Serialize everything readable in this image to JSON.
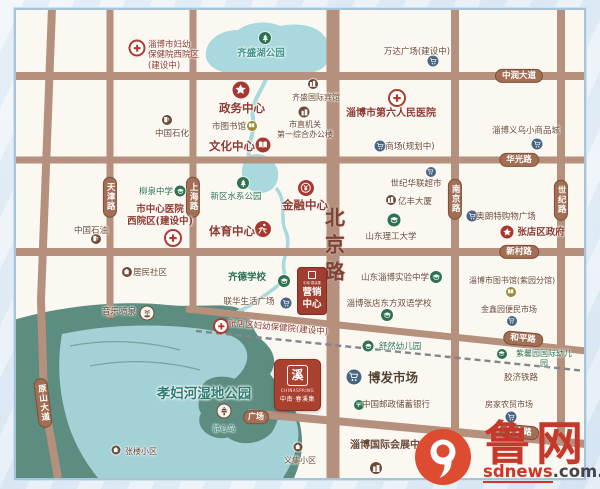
{
  "colors": {
    "maroon": "#8e3a30",
    "brown": "#6d4a36",
    "green": "#2e7350",
    "teal": "#3f948c",
    "blue": "#4a6580",
    "red": "#a8372e",
    "olive": "#9c8b33",
    "darkbrown": "#54412e",
    "wetland": "#2f7d72"
  },
  "big_road": {
    "t": "北京路"
  },
  "road_labels": [
    {
      "id": "zhongrun-avenue",
      "t": "中润大道",
      "x": 519,
      "y": 76
    },
    {
      "id": "huaguang-road",
      "t": "华光路",
      "x": 519,
      "y": 160
    },
    {
      "id": "xincun-road",
      "t": "新村路",
      "x": 519,
      "y": 252
    },
    {
      "id": "heping-road",
      "t": "和平路",
      "x": 523,
      "y": 339,
      "r": 5
    },
    {
      "id": "wangshe-road",
      "t": "王舍路",
      "x": 519,
      "y": 432,
      "r": 5
    },
    {
      "id": "tianjin-road",
      "t": "天津路",
      "x": 110,
      "y": 197,
      "v": 1
    },
    {
      "id": "shanghai-road",
      "t": "上海路",
      "x": 193,
      "y": 197,
      "v": 1
    },
    {
      "id": "nanjing-road",
      "t": "南京路",
      "x": 455,
      "y": 199,
      "v": 1
    },
    {
      "id": "shiji-road",
      "t": "世纪路",
      "x": 561,
      "y": 200,
      "v": 1
    },
    {
      "id": "yuanshan-avenue",
      "t": "原山大道",
      "x": 43,
      "y": 403,
      "v": 1,
      "r": -7
    },
    {
      "id": "plaza",
      "t": "广场",
      "x": 256,
      "y": 417,
      "small": 1
    }
  ],
  "pois": [
    {
      "id": "zibo-maternity-west-hospital",
      "ic": "cross",
      "c": "ring",
      "x": 137,
      "y": 48,
      "s": 13
    },
    {
      "id": "sinopec",
      "ic": "pump",
      "c": "brown",
      "x": 167,
      "y": 120,
      "s": 10
    },
    {
      "id": "government-center",
      "ic": "star",
      "c": "red",
      "x": 241,
      "y": 90,
      "s": 17
    },
    {
      "id": "city-library",
      "ic": "book",
      "c": "olive",
      "x": 252,
      "y": 126,
      "s": 10
    },
    {
      "id": "culture-center",
      "ic": "book",
      "c": "red",
      "x": 263,
      "y": 145,
      "s": 15
    },
    {
      "id": "qisheng-lake-park",
      "ic": "tree",
      "c": "green",
      "x": 265,
      "y": 38,
      "s": 12
    },
    {
      "id": "qisheng-intl-hotel",
      "ic": "building",
      "c": "brown",
      "x": 313,
      "y": 84,
      "s": 10
    },
    {
      "id": "municipal-office",
      "ic": "building",
      "c": "brown",
      "x": 304,
      "y": 112,
      "s": 11
    },
    {
      "id": "wanda-plaza",
      "ic": "cart",
      "c": "blue",
      "x": 433,
      "y": 61,
      "s": 11
    },
    {
      "id": "sixth-peoples-hospital",
      "ic": "cross",
      "c": "ring",
      "x": 397,
      "y": 98,
      "s": 14
    },
    {
      "id": "yiwu-commodity-city",
      "ic": "cart",
      "c": "blue",
      "x": 537,
      "y": 144,
      "s": 11
    },
    {
      "id": "mall-planned",
      "ic": "cart",
      "c": "blue",
      "x": 380,
      "y": 146,
      "s": 11
    },
    {
      "id": "century-hualian-supermarket",
      "ic": "cart",
      "c": "blue",
      "x": 431,
      "y": 172,
      "s": 10
    },
    {
      "id": "yifeng-tower",
      "ic": "building",
      "c": "brown",
      "x": 391,
      "y": 200,
      "s": 10
    },
    {
      "id": "aolangte-mall",
      "ic": "cart",
      "c": "blue",
      "x": 472,
      "y": 216,
      "s": 11
    },
    {
      "id": "zhangdian-government",
      "ic": "star",
      "c": "red",
      "x": 507,
      "y": 232,
      "s": 13
    },
    {
      "id": "shandong-univ-tech",
      "ic": "cap",
      "c": "green",
      "x": 394,
      "y": 220,
      "s": 13
    },
    {
      "id": "liuquan-middle-school",
      "ic": "cap",
      "c": "green",
      "x": 180,
      "y": 191,
      "s": 11
    },
    {
      "id": "central-hospital-west",
      "ic": "cross",
      "c": "ring",
      "x": 173,
      "y": 238,
      "s": 14
    },
    {
      "id": "petrochina",
      "ic": "pump",
      "c": "brown",
      "x": 96,
      "y": 239,
      "s": 10
    },
    {
      "id": "residential-community",
      "ic": "house",
      "c": "brown",
      "x": 127,
      "y": 272,
      "s": 10
    },
    {
      "id": "water-system-park",
      "ic": "tree",
      "c": "green",
      "x": 243,
      "y": 183,
      "s": 12
    },
    {
      "id": "sports-center",
      "ic": "runner",
      "c": "red",
      "x": 263,
      "y": 229,
      "s": 16
    },
    {
      "id": "finance-center",
      "ic": "money",
      "c": "red",
      "x": 306,
      "y": 188,
      "s": 16
    },
    {
      "id": "qide-school",
      "ic": "cap",
      "c": "green",
      "x": 284,
      "y": 281,
      "s": 12
    },
    {
      "id": "lianhua-life-plaza",
      "ic": "cart",
      "c": "blue",
      "x": 286,
      "y": 303,
      "s": 11
    },
    {
      "id": "zhangdian-maternity-hospital",
      "ic": "cross",
      "c": "ring",
      "x": 221,
      "y": 326,
      "s": 12
    },
    {
      "id": "experimental-middle-school",
      "ic": "cap",
      "c": "green",
      "x": 436,
      "y": 277,
      "s": 12
    },
    {
      "id": "library-ziyuan-branch",
      "ic": "book",
      "c": "olive",
      "x": 511,
      "y": 292,
      "s": 10
    },
    {
      "id": "oriental-bilingual-school",
      "ic": "cap",
      "c": "green",
      "x": 387,
      "y": 315,
      "s": 12
    },
    {
      "id": "jinxinyuan-market",
      "ic": "cart",
      "c": "blue",
      "x": 512,
      "y": 321,
      "s": 10
    },
    {
      "id": "shuran-kindergarten",
      "ic": "cap",
      "c": "green",
      "x": 368,
      "y": 346,
      "s": 11
    },
    {
      "id": "zixinyuan-kindergarten",
      "ic": "cap",
      "c": "green",
      "x": 502,
      "y": 354,
      "s": 10
    },
    {
      "id": "bofa-market",
      "ic": "cart",
      "c": "blue",
      "x": 354,
      "y": 377,
      "s": 15
    },
    {
      "id": "postal-savings-bank",
      "ic": "post",
      "c": "green",
      "x": 359,
      "y": 405,
      "s": 10
    },
    {
      "id": "fangjia-market",
      "ic": "cart",
      "c": "blue",
      "x": 511,
      "y": 417,
      "s": 11
    },
    {
      "id": "intl-convention-center",
      "ic": "building",
      "c": "brown",
      "x": 376,
      "y": 468,
      "s": 12
    },
    {
      "id": "yiji-community",
      "ic": "house",
      "c": "brown",
      "x": 298,
      "y": 447,
      "s": 9
    },
    {
      "id": "zhanglou-community",
      "ic": "house",
      "c": "brown",
      "x": 116,
      "y": 450,
      "s": 9
    },
    {
      "id": "music-fountain",
      "ic": "fountain",
      "c": "wb",
      "x": 147,
      "y": 313,
      "s": 13
    },
    {
      "id": "jingxin-island-pagoda",
      "ic": "pagoda",
      "c": "wb",
      "x": 224,
      "y": 411,
      "s": 13
    }
  ],
  "labels": [
    {
      "id": "zibo-maternity-west-hospital",
      "t": "淄博市妇幼\n保健院西院区\n(建设中)",
      "x": 148,
      "y": 40,
      "c": "maroon",
      "s": 8.5,
      "a": "l"
    },
    {
      "id": "sinopec",
      "t": "中国石化",
      "x": 172,
      "y": 129,
      "c": "brown",
      "s": 8.5
    },
    {
      "id": "government-center",
      "t": "政务中心",
      "x": 242,
      "y": 101,
      "c": "maroon",
      "s": 11.5,
      "b": 1
    },
    {
      "id": "city-library",
      "t": "市图书馆",
      "x": 229,
      "y": 122,
      "c": "brown",
      "s": 8.5
    },
    {
      "id": "culture-center",
      "t": "文化中心",
      "x": 232,
      "y": 139,
      "c": "maroon",
      "s": 11.5,
      "b": 1
    },
    {
      "id": "qisheng-lake-park",
      "t": "齐盛湖公园",
      "x": 261,
      "y": 48,
      "c": "teal",
      "s": 9.5,
      "b": 1
    },
    {
      "id": "qisheng-intl-hotel",
      "t": "齐盛国际宾馆",
      "x": 316,
      "y": 93,
      "c": "brown",
      "s": 8
    },
    {
      "id": "municipal-office",
      "t": "市直机关\n第一综合办公楼",
      "x": 305,
      "y": 120,
      "c": "brown",
      "s": 8
    },
    {
      "id": "wanda-plaza",
      "t": "万达广场(建设中)",
      "x": 417,
      "y": 47,
      "c": "brown",
      "s": 8.5
    },
    {
      "id": "sixth-peoples-hospital",
      "t": "淄博市第六人民医院",
      "x": 391,
      "y": 108,
      "c": "maroon",
      "s": 10,
      "b": 1
    },
    {
      "id": "yiwu-commodity-city",
      "t": "淄博义乌小商品城",
      "x": 526,
      "y": 126,
      "c": "brown",
      "s": 8.5
    },
    {
      "id": "mall-planned",
      "t": "商场(规划中)",
      "x": 410,
      "y": 142,
      "c": "brown",
      "s": 8.5
    },
    {
      "id": "century-hualian-supermarket",
      "t": "世纪华联超市",
      "x": 416,
      "y": 179,
      "c": "brown",
      "s": 8.5
    },
    {
      "id": "yifeng-tower",
      "t": "亿丰大厦",
      "x": 415,
      "y": 197,
      "c": "brown",
      "s": 8.5
    },
    {
      "id": "aolangte-mall",
      "t": "奥朗特购物广场",
      "x": 506,
      "y": 212,
      "c": "brown",
      "s": 8.5
    },
    {
      "id": "zhangdian-government",
      "t": "张店区政府",
      "x": 541,
      "y": 227,
      "c": "maroon",
      "s": 9.5,
      "b": 1
    },
    {
      "id": "shandong-univ-tech",
      "t": "山东理工大学",
      "x": 391,
      "y": 232,
      "c": "brown",
      "s": 8.5
    },
    {
      "id": "liuquan-middle-school",
      "t": "柳泉中学",
      "x": 156,
      "y": 187,
      "c": "green",
      "s": 8.5
    },
    {
      "id": "central-hospital-west",
      "t": "市中心医院\n西院区(建设中)",
      "x": 160,
      "y": 204,
      "c": "maroon",
      "s": 9.5,
      "b": 1
    },
    {
      "id": "petrochina",
      "t": "中国石油",
      "x": 91,
      "y": 226,
      "c": "brown",
      "s": 8.5
    },
    {
      "id": "residential-community",
      "t": "居民社区",
      "x": 150,
      "y": 268,
      "c": "brown",
      "s": 8.5
    },
    {
      "id": "water-system-park",
      "t": "新区水系公园",
      "x": 236,
      "y": 192,
      "c": "green",
      "s": 8.5
    },
    {
      "id": "sports-center",
      "t": "体育中心",
      "x": 232,
      "y": 224,
      "c": "maroon",
      "s": 11.5,
      "b": 1
    },
    {
      "id": "finance-center",
      "t": "金融中心",
      "x": 305,
      "y": 198,
      "c": "maroon",
      "s": 11.5,
      "b": 1
    },
    {
      "id": "qide-school",
      "t": "齐德学校",
      "x": 247,
      "y": 272,
      "c": "green",
      "s": 9.5,
      "b": 1
    },
    {
      "id": "lianhua-life-plaza",
      "t": "联华生活广场",
      "x": 249,
      "y": 297,
      "c": "brown",
      "s": 8.5
    },
    {
      "id": "zhangdian-maternity-hospital",
      "t": "张店区妇幼保健院(建设中)",
      "x": 278,
      "y": 323,
      "c": "maroon",
      "s": 8.5,
      "r": 5
    },
    {
      "id": "experimental-middle-school",
      "t": "山东淄博实验中学",
      "x": 395,
      "y": 273,
      "c": "brown",
      "s": 8.5
    },
    {
      "id": "library-ziyuan-branch",
      "t": "淄博市图书馆(紫园分馆)",
      "x": 512,
      "y": 276,
      "c": "brown",
      "s": 8
    },
    {
      "id": "oriental-bilingual-school",
      "t": "淄博张店东方双语学校",
      "x": 389,
      "y": 299,
      "c": "brown",
      "s": 8.5
    },
    {
      "id": "jinxinyuan-market",
      "t": "金鑫园便民市场",
      "x": 509,
      "y": 305,
      "c": "brown",
      "s": 8
    },
    {
      "id": "shuran-kindergarten",
      "t": "舒然幼儿园",
      "x": 400,
      "y": 342,
      "c": "green",
      "s": 8.5
    },
    {
      "id": "zixinyuan-kindergarten",
      "t": "紫馨园国际幼儿园",
      "x": 544,
      "y": 349,
      "c": "green",
      "s": 8
    },
    {
      "id": "jiaoji-railway",
      "t": "胶济铁路",
      "x": 521,
      "y": 373,
      "c": "brown",
      "s": 8.5
    },
    {
      "id": "bofa-market",
      "t": "博发市场",
      "x": 393,
      "y": 370,
      "c": "darkbrown",
      "s": 12.5,
      "b": 1
    },
    {
      "id": "postal-savings-bank",
      "t": "中国邮政储蓄银行",
      "x": 396,
      "y": 400,
      "c": "brown",
      "s": 8.5
    },
    {
      "id": "fangjia-market",
      "t": "房家农贸市场",
      "x": 509,
      "y": 400,
      "c": "brown",
      "s": 8
    },
    {
      "id": "intl-convention-center",
      "t": "淄博国际会展中心",
      "x": 390,
      "y": 440,
      "c": "brown",
      "s": 10,
      "b": 1
    },
    {
      "id": "yiji-community",
      "t": "义集小区",
      "x": 300,
      "y": 456,
      "c": "brown",
      "s": 8
    },
    {
      "id": "zhanglou-community",
      "t": "张楼小区",
      "x": 141,
      "y": 447,
      "c": "brown",
      "s": 8
    },
    {
      "id": "music-fountain",
      "t": "音乐喷泉",
      "x": 119,
      "y": 307,
      "c": "darkbrown",
      "s": 8.5
    },
    {
      "id": "xiaofu-river-wetland-park",
      "t": "孝妇河湿地公园",
      "x": 204,
      "y": 386,
      "c": "wetland",
      "s": 13.5,
      "b": 1
    },
    {
      "id": "jingxin-island",
      "t": "静心岛",
      "x": 224,
      "y": 424,
      "c": "wetland",
      "s": 7.5
    }
  ],
  "sales_center": {
    "line1": "营销",
    "line2": "中心",
    "brand": "中南·春溪集"
  },
  "project": {
    "seal": "溪",
    "en": "CHINASPRING",
    "cn": "中南·春溪集"
  },
  "watermark": {
    "site": "鲁网",
    "domain_red": "sdnews",
    "domain_dark": ".com.cn"
  }
}
